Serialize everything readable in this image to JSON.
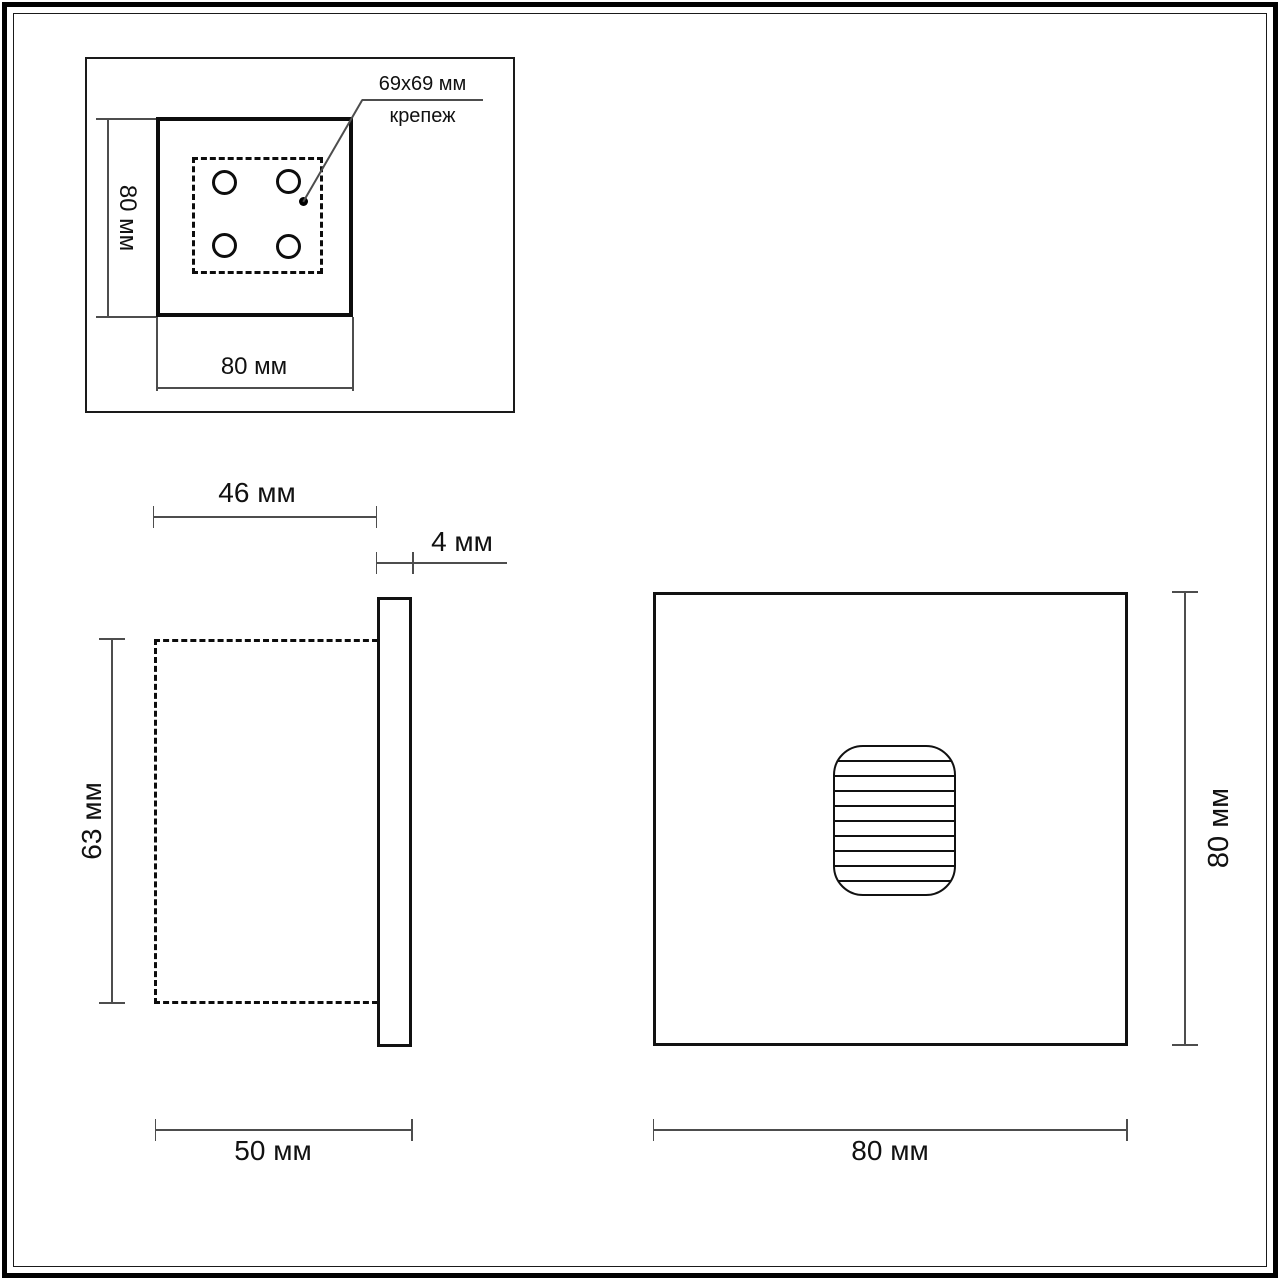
{
  "drawing_title": "wall-light-dimension-drawing",
  "units": "мм",
  "colors": {
    "background": "#ffffff",
    "stroke": "#111111",
    "dimension_line": "#4d4d4d"
  },
  "top_view": {
    "dim_height": "80 мм",
    "dim_width": "80 мм",
    "annotation": {
      "size": "69x69 мм",
      "name": "крепеж"
    },
    "mounting_holes_count": 4
  },
  "side_view": {
    "dim_body_depth": "46 мм",
    "dim_plate_thickness": "4 мм",
    "dim_body_height": "63 мм",
    "dim_total_depth": "50 мм"
  },
  "front_view": {
    "dim_height": "80 мм",
    "dim_width": "80 мм"
  }
}
